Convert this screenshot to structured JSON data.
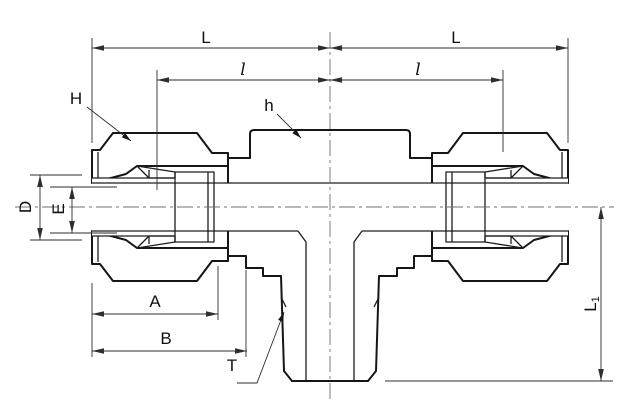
{
  "drawing": {
    "type": "engineering-dimension-drawing",
    "subject": "male-branch-tee-tube-fitting-cross-section",
    "labels": {
      "L_left": "L",
      "L_right": "L",
      "l_left": "l",
      "l_right": "l",
      "H": "H",
      "h": "h",
      "D": "D",
      "E": "E",
      "A": "A",
      "B": "B",
      "T": "T",
      "L1_main": "L",
      "L1_sub": "1"
    },
    "colors": {
      "background": "#ffffff",
      "metal_fill": "#d7d7d7",
      "body_fill": "#dcdcdc",
      "outline": "#161616",
      "dimension_line": "#2e2e2e",
      "centerline": "#707070"
    }
  }
}
